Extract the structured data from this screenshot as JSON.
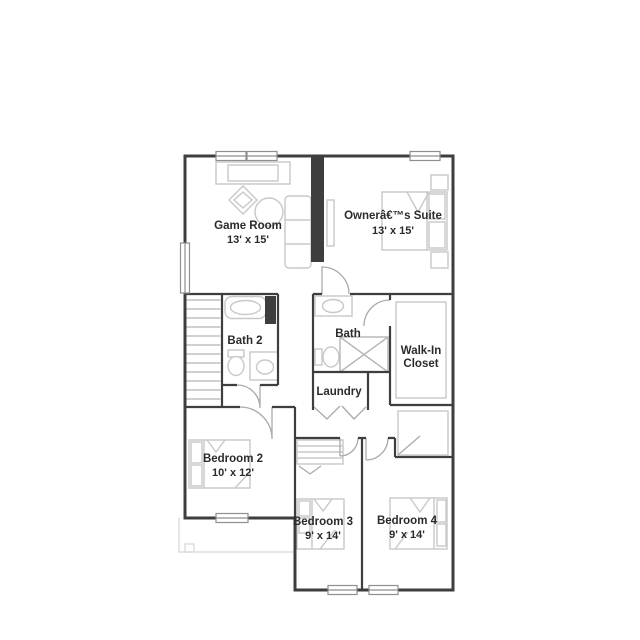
{
  "colors": {
    "wall": "#3e3e3e",
    "fixture": "#c8c8c8",
    "door": "#aaaaaa",
    "text": "#2b2b2b",
    "window_frame": "#8f8f8f",
    "stair_tread": "#b5b5b5",
    "roof_line": "#dedede"
  },
  "rooms": {
    "game_room": {
      "name": "Game Room",
      "dims": "13' x 15'"
    },
    "owners_suite": {
      "name": "Ownerâ€™s Suite",
      "dims": "13' x 15'"
    },
    "bath_2": {
      "name": "Bath 2"
    },
    "bath": {
      "name": "Bath"
    },
    "walk_in_closet": {
      "name_line_1": "Walk-In",
      "name_line_2": "Closet"
    },
    "laundry": {
      "name": "Laundry"
    },
    "bedroom_2": {
      "name": "Bedroom 2",
      "dims": "10' x 12'"
    },
    "bedroom_3": {
      "name": "Bedroom 3",
      "dims": "9' x 14'"
    },
    "bedroom_4": {
      "name": "Bedroom 4",
      "dims": "9' x 14'"
    }
  }
}
